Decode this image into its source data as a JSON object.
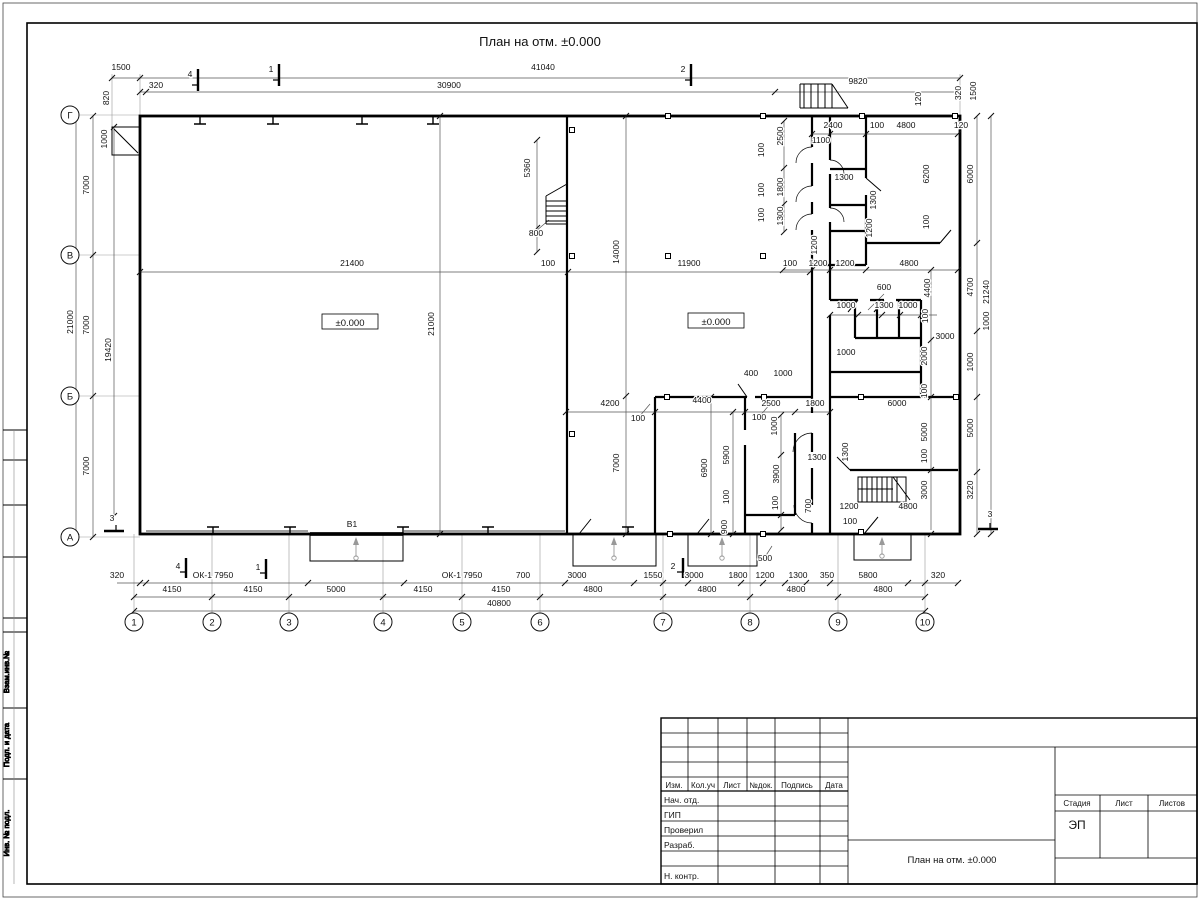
{
  "sheet": {
    "title": "План на отм. ±0.000"
  },
  "plan": {
    "labels": [
      [
        "1500",
        121,
        70,
        0
      ],
      [
        "41040",
        543,
        70,
        0
      ],
      [
        "320",
        156,
        88,
        0
      ],
      [
        "30900",
        449,
        88,
        0
      ],
      [
        "9820",
        858,
        84,
        0
      ],
      [
        "4",
        190,
        77,
        0,
        11
      ],
      [
        "1",
        271,
        72,
        0,
        11
      ],
      [
        "2",
        683,
        72,
        0,
        11
      ],
      [
        "820",
        109,
        98,
        1
      ],
      [
        "120",
        921,
        99,
        1
      ],
      [
        "320",
        961,
        93,
        1
      ],
      [
        "1500",
        976,
        91,
        1
      ],
      [
        "1000",
        107,
        139,
        1
      ],
      [
        "7000",
        89,
        185,
        1
      ],
      [
        "7000",
        89,
        325,
        1
      ],
      [
        "7000",
        89,
        466,
        1
      ],
      [
        "21000",
        73,
        322,
        1
      ],
      [
        "19420",
        111,
        350,
        1
      ],
      [
        "3",
        112,
        521,
        0,
        11
      ],
      [
        "6000",
        973,
        174,
        1
      ],
      [
        "4700",
        973,
        287,
        1
      ],
      [
        "21240",
        989,
        292,
        1
      ],
      [
        "1000",
        989,
        321,
        1
      ],
      [
        "1000",
        973,
        362,
        1
      ],
      [
        "5000",
        973,
        428,
        1
      ],
      [
        "3220",
        973,
        490,
        1
      ],
      [
        "3",
        990,
        517,
        0,
        11
      ],
      [
        "320",
        117,
        578,
        0
      ],
      [
        "ОК-1 7950",
        213,
        578,
        0
      ],
      [
        "4",
        178,
        569,
        0,
        11
      ],
      [
        "1",
        258,
        570,
        0,
        11
      ],
      [
        "ОК-1 7950",
        462,
        578,
        0
      ],
      [
        "700",
        523,
        578,
        0
      ],
      [
        "3000",
        577,
        578,
        0
      ],
      [
        "1550",
        653,
        578,
        0
      ],
      [
        "2",
        673,
        569,
        0,
        11
      ],
      [
        "3000",
        694,
        578,
        0
      ],
      [
        "1800",
        738,
        578,
        0
      ],
      [
        "1200",
        765,
        578,
        0
      ],
      [
        "500",
        765,
        561,
        0
      ],
      [
        "1300",
        798,
        578,
        0
      ],
      [
        "350",
        827,
        578,
        0
      ],
      [
        "5800",
        868,
        578,
        0
      ],
      [
        "320",
        938,
        578,
        0
      ],
      [
        "4150",
        172,
        592,
        0
      ],
      [
        "4150",
        253,
        592,
        0
      ],
      [
        "5000",
        336,
        592,
        0
      ],
      [
        "4150",
        423,
        592,
        0
      ],
      [
        "4150",
        501,
        592,
        0
      ],
      [
        "4800",
        593,
        592,
        0
      ],
      [
        "4800",
        707,
        592,
        0
      ],
      [
        "4800",
        796,
        592,
        0
      ],
      [
        "4800",
        883,
        592,
        0
      ],
      [
        "40800",
        499,
        606,
        0
      ],
      [
        "2400",
        833,
        128,
        0
      ],
      [
        "100",
        877,
        128,
        0
      ],
      [
        "4800",
        906,
        128,
        0
      ],
      [
        "120",
        961,
        128,
        0
      ],
      [
        "1100",
        821,
        143,
        0
      ],
      [
        "1300",
        844,
        180,
        0
      ],
      [
        "100",
        764,
        150,
        1
      ],
      [
        "2500",
        783,
        136,
        1
      ],
      [
        "100",
        764,
        190,
        1
      ],
      [
        "1800",
        783,
        187,
        1
      ],
      [
        "100",
        764,
        215,
        1
      ],
      [
        "1300",
        783,
        216,
        1
      ],
      [
        "6200",
        929,
        174,
        1
      ],
      [
        "100",
        929,
        222,
        1
      ],
      [
        "1300",
        876,
        200,
        1
      ],
      [
        "1200",
        872,
        228,
        1
      ],
      [
        "1200",
        817,
        245,
        1
      ],
      [
        "100",
        789,
        266,
        0
      ],
      [
        "1200",
        818,
        266,
        0
      ],
      [
        "1200",
        845,
        266,
        0
      ],
      [
        "4800",
        909,
        266,
        0
      ],
      [
        "600",
        884,
        290,
        0
      ],
      [
        "1000",
        846,
        308,
        0
      ],
      [
        "1300",
        884,
        308,
        0
      ],
      [
        "1000",
        908,
        308,
        0
      ],
      [
        "100",
        928,
        316,
        1
      ],
      [
        "4400",
        930,
        288,
        1
      ],
      [
        "3000",
        945,
        339,
        0
      ],
      [
        "2000",
        927,
        356,
        1
      ],
      [
        "1000",
        846,
        355,
        0
      ],
      [
        "100",
        927,
        391,
        1
      ],
      [
        "6000",
        897,
        406,
        0
      ],
      [
        "1800",
        815,
        406,
        0
      ],
      [
        "21400",
        352,
        266,
        0
      ],
      [
        "100",
        548,
        266,
        0
      ],
      [
        "11900",
        689,
        266,
        0
      ],
      [
        "100",
        790,
        266,
        0
      ],
      [
        "21000",
        434,
        324,
        1
      ],
      [
        "14000",
        619,
        252,
        1
      ],
      [
        "7000",
        619,
        463,
        1
      ],
      [
        "5360",
        530,
        168,
        1
      ],
      [
        "800",
        536,
        236,
        0
      ],
      [
        "В1",
        352,
        527,
        0,
        9
      ],
      [
        "4200",
        610,
        406,
        0
      ],
      [
        "4400",
        702,
        403,
        0
      ],
      [
        "2500",
        771,
        406,
        0
      ],
      [
        "100",
        638,
        421,
        0
      ],
      [
        "100",
        759,
        420,
        0
      ],
      [
        "400",
        751,
        376,
        0
      ],
      [
        "1000",
        783,
        376,
        0
      ],
      [
        "1000",
        777,
        426,
        1
      ],
      [
        "5900",
        729,
        455,
        1
      ],
      [
        "6900",
        707,
        468,
        1
      ],
      [
        "3900",
        779,
        474,
        1
      ],
      [
        "100",
        729,
        497,
        1
      ],
      [
        "100",
        778,
        503,
        1
      ],
      [
        "900",
        727,
        527,
        1
      ],
      [
        "700",
        811,
        506,
        1
      ],
      [
        "1300",
        817,
        460,
        0
      ],
      [
        "1300",
        848,
        452,
        1
      ],
      [
        "1200",
        849,
        509,
        0
      ],
      [
        "100",
        850,
        524,
        0
      ],
      [
        "4800",
        908,
        509,
        0
      ],
      [
        "3000",
        927,
        490,
        1
      ],
      [
        "5000",
        927,
        432,
        1
      ],
      [
        "100",
        927,
        456,
        1
      ]
    ],
    "elevations": [
      {
        "t": "±0.000",
        "x": 350,
        "y": 324
      },
      {
        "t": "±0.000",
        "x": 716,
        "y": 323
      }
    ],
    "axes": {
      "rows": [
        [
          "Г",
          115
        ],
        [
          "В",
          255
        ],
        [
          "Б",
          396
        ],
        [
          "А",
          537
        ]
      ],
      "cols": [
        [
          "1",
          134
        ],
        [
          "2",
          212
        ],
        [
          "3",
          289
        ],
        [
          "4",
          383
        ],
        [
          "5",
          462
        ],
        [
          "6",
          540
        ],
        [
          "7",
          663
        ],
        [
          "8",
          750
        ],
        [
          "9",
          838
        ],
        [
          "10",
          925
        ]
      ]
    }
  },
  "title_block": {
    "izm": "Изм.",
    "koluch": "Кол.уч",
    "list": "Лист",
    "ndok": "№док.",
    "podpis": "Подпись",
    "data": "Дата",
    "nach_otd": "Нач. отд.",
    "gip": "ГИП",
    "proveril": "Проверил",
    "razrab": "Разраб.",
    "n_kontr": "Н. контр.",
    "stadia": "Стадия",
    "list2": "Лист",
    "listov": "Листов",
    "ep": "ЭП",
    "drawing_name": "План на отм. ±0.000"
  },
  "side_stamp": {
    "vzam": "Взам.инв.№",
    "podp": "Подп. и дата",
    "inv": "Инв. № подл."
  }
}
